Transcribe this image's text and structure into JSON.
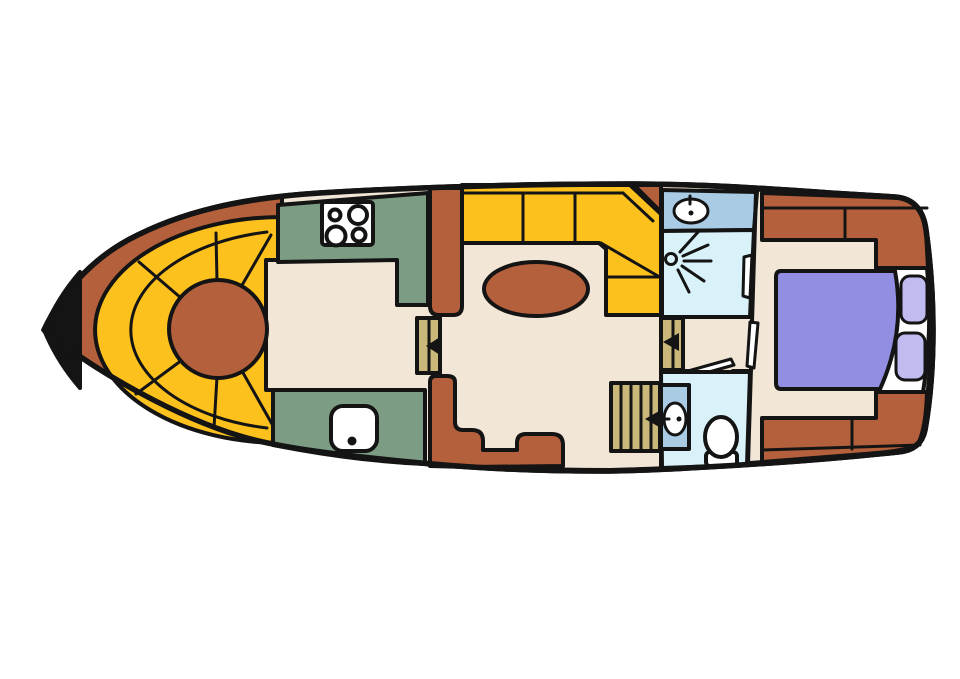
{
  "colors": {
    "background": "#ffffff",
    "outline": "#141414",
    "hull": "#b5603c",
    "floor": "#f2e6d6",
    "seat_yellow": "#fcc11c",
    "counter_green": "#7d9c84",
    "wet_blue": "#d9f1f8",
    "basin_blue": "#a9cce4",
    "bed_purple": "#928fe2",
    "pillow_purple": "#c0bcf0",
    "wood_tan": "#c9b87a",
    "white_fixture": "#ffffff",
    "table_brown": "#b5603c"
  },
  "areas": {
    "bow_seating": "bow-curved-bench",
    "bow_table": "round-bow-table",
    "galley": "galley-counters",
    "stove": "four-burner-stove",
    "galley_sink": "galley-sink",
    "salon": "salon-floor",
    "dinette_bench": "l-shaped-bench",
    "dinette_table": "oval-table",
    "washroom": "shower-room",
    "washbasin": "washbasin",
    "shower": "shower-head",
    "toilet_room": "toilet-room",
    "toilet": "toilet",
    "stairs": "companionway-stairs",
    "doors": "sliding-doors-with-arrows",
    "aft_cabin": "aft-cabin",
    "bed": "double-bed",
    "pillows": "pillows",
    "side_decks": "side-decks"
  }
}
